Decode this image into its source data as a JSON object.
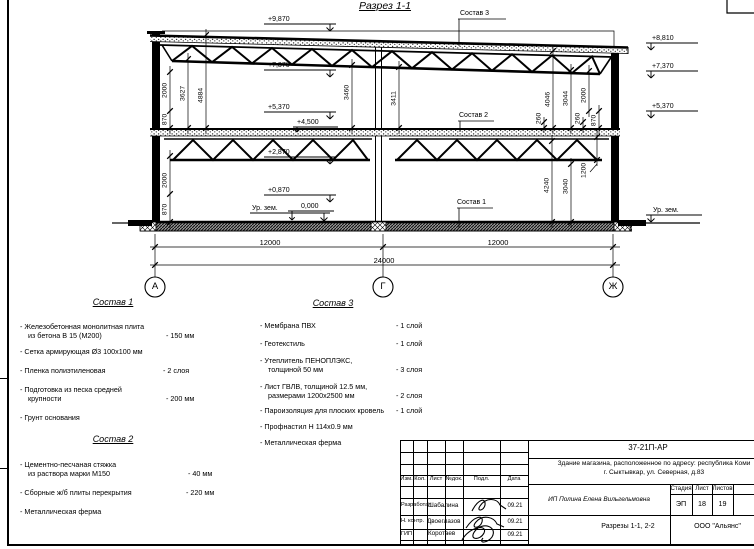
{
  "colors": {
    "line": "#000000",
    "paper": "#ffffff"
  },
  "title": {
    "section": "Разрез 1-1"
  },
  "drawing": {
    "levels_left": [
      "+9,870",
      "+7,370",
      "+5,370",
      "+2,870",
      "+0,870",
      "Ур. зем."
    ],
    "levels_right": [
      "+8,810",
      "+7,370",
      "+5,370",
      "Ур. зем."
    ],
    "slab_marks": {
      "upper": "+4,500",
      "lower": "0,000"
    },
    "leaders": {
      "c1": "Состав 1",
      "c2": "Состав 2",
      "c3": "Состав 3"
    },
    "vdims": [
      "2000",
      "870",
      "3627",
      "4884",
      "3460",
      "3411",
      "4046",
      "3044",
      "2000",
      "260",
      "260",
      "870",
      "2000",
      "870",
      "4240",
      "3040",
      "1200"
    ],
    "hdims": [
      "12000",
      "12000",
      "24000"
    ],
    "axes": [
      "А",
      "Г",
      "Ж"
    ]
  },
  "comp1": {
    "title": "Состав 1",
    "items": [
      {
        "l1": "- Железобетонная  монолитная плита",
        "l2": "из бетона В 15 (М200)",
        "v": "- 150 мм"
      },
      {
        "l1": "- Сетка армирующая Ø3 100х100 мм",
        "l2": "",
        "v": ""
      },
      {
        "l1": "- Пленка полиэтиленовая",
        "l2": "",
        "v": "-  2 слоя"
      },
      {
        "l1": "- Подготовка из песка средней",
        "l2": "крупности",
        "v": "- 200 мм"
      },
      {
        "l1": "- Грунт основания",
        "l2": "",
        "v": ""
      }
    ]
  },
  "comp2": {
    "title": "Состав 2",
    "items": [
      {
        "l1": "- Цементно-песчаная стяжка",
        "l2": "из раствора марки М150",
        "v": "- 40 мм"
      },
      {
        "l1": "- Сборные ж/б плиты перекрытия",
        "l2": "",
        "v": "- 220 мм"
      },
      {
        "l1": "- Металлическая ферма",
        "l2": "",
        "v": ""
      }
    ]
  },
  "comp3": {
    "title": "Состав 3",
    "items": [
      {
        "l1": "- Мембрана ПВХ",
        "l2": "",
        "v": "- 1 слой"
      },
      {
        "l1": "- Геотекстиль",
        "l2": "",
        "v": "- 1 слой"
      },
      {
        "l1": "- Утеплитель ПЕНОПЛЭКС,",
        "l2": "толщиной 50 мм",
        "v": "- 3 слоя"
      },
      {
        "l1": "- Лист ГВЛВ, толщиной 12.5 мм,",
        "l2": "размерами 1200х2500 мм",
        "v": "- 2 слоя"
      },
      {
        "l1": "- Пароизоляция для плоских кровель",
        "l2": "",
        "v": "- 1 слой"
      },
      {
        "l1": "- Профнастил Н 114х0.9 мм",
        "l2": "",
        "v": ""
      },
      {
        "l1": "- Металлическая ферма",
        "l2": "",
        "v": ""
      }
    ]
  },
  "stamp": {
    "doc_number": "37-21П-АР",
    "object_line1": "Здание магазина, расположенное по адресу: республика Коми",
    "object_line2": "г. Сыктывкар, ул. Северная, д.83",
    "client": "ИП Полина Елена Вильгельмовна",
    "sheet_title": "Разрезы 1-1, 2-2",
    "company": "ООО \"Альянс\"",
    "cols": {
      "izm": "Изм.",
      "kol": "Кол.",
      "list": "Лист",
      "ndok": "№док.",
      "podl": "Подл.",
      "data": "Дата"
    },
    "stage_label": "Стадия",
    "sheet_label": "Лист",
    "sheets_label": "Листов",
    "stage": "ЭП",
    "sheet_no": "18",
    "sheets_total": "19",
    "rows": [
      {
        "role": "Разработал",
        "name": "Шабалина",
        "date": "09.21"
      },
      {
        "role": "Н. контр.",
        "name": "Двоеглазов",
        "date": "09.21"
      },
      {
        "role": "ГИП",
        "name": "Коротаев",
        "date": "09.21"
      }
    ]
  }
}
